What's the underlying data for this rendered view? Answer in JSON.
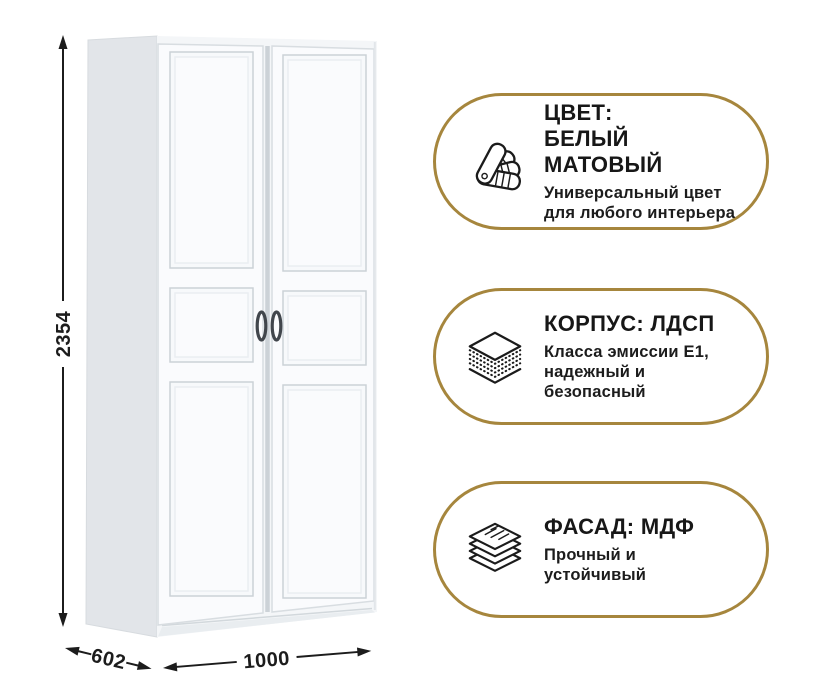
{
  "page": {
    "background": "#ffffff"
  },
  "colors": {
    "accent_gold": "#a6863d",
    "text_dark": "#1b1b1b",
    "wardrobe_side": "#e2e5e9",
    "wardrobe_front": "#f4f6f8"
  },
  "wardrobe": {
    "description": "white two-door wardrobe with framed panel doors",
    "dimensions": {
      "height": "2354",
      "depth": "602",
      "width": "1000"
    }
  },
  "badges": [
    {
      "icon": "color-swatch-fan-icon",
      "title": "ЦВЕТ:\nБЕЛЫЙ МАТОВЫЙ",
      "subtitle": "Универсальный цвет\nдля любого интерьера"
    },
    {
      "icon": "chipboard-layers-icon",
      "title": "КОРПУС: ЛДСП",
      "subtitle": "Класса эмиссии Е1,\nнадежный и\nбезопасный"
    },
    {
      "icon": "mdf-sheets-icon",
      "title": "ФАСАД: МДФ",
      "subtitle": "Прочный и\nустойчивый"
    }
  ]
}
